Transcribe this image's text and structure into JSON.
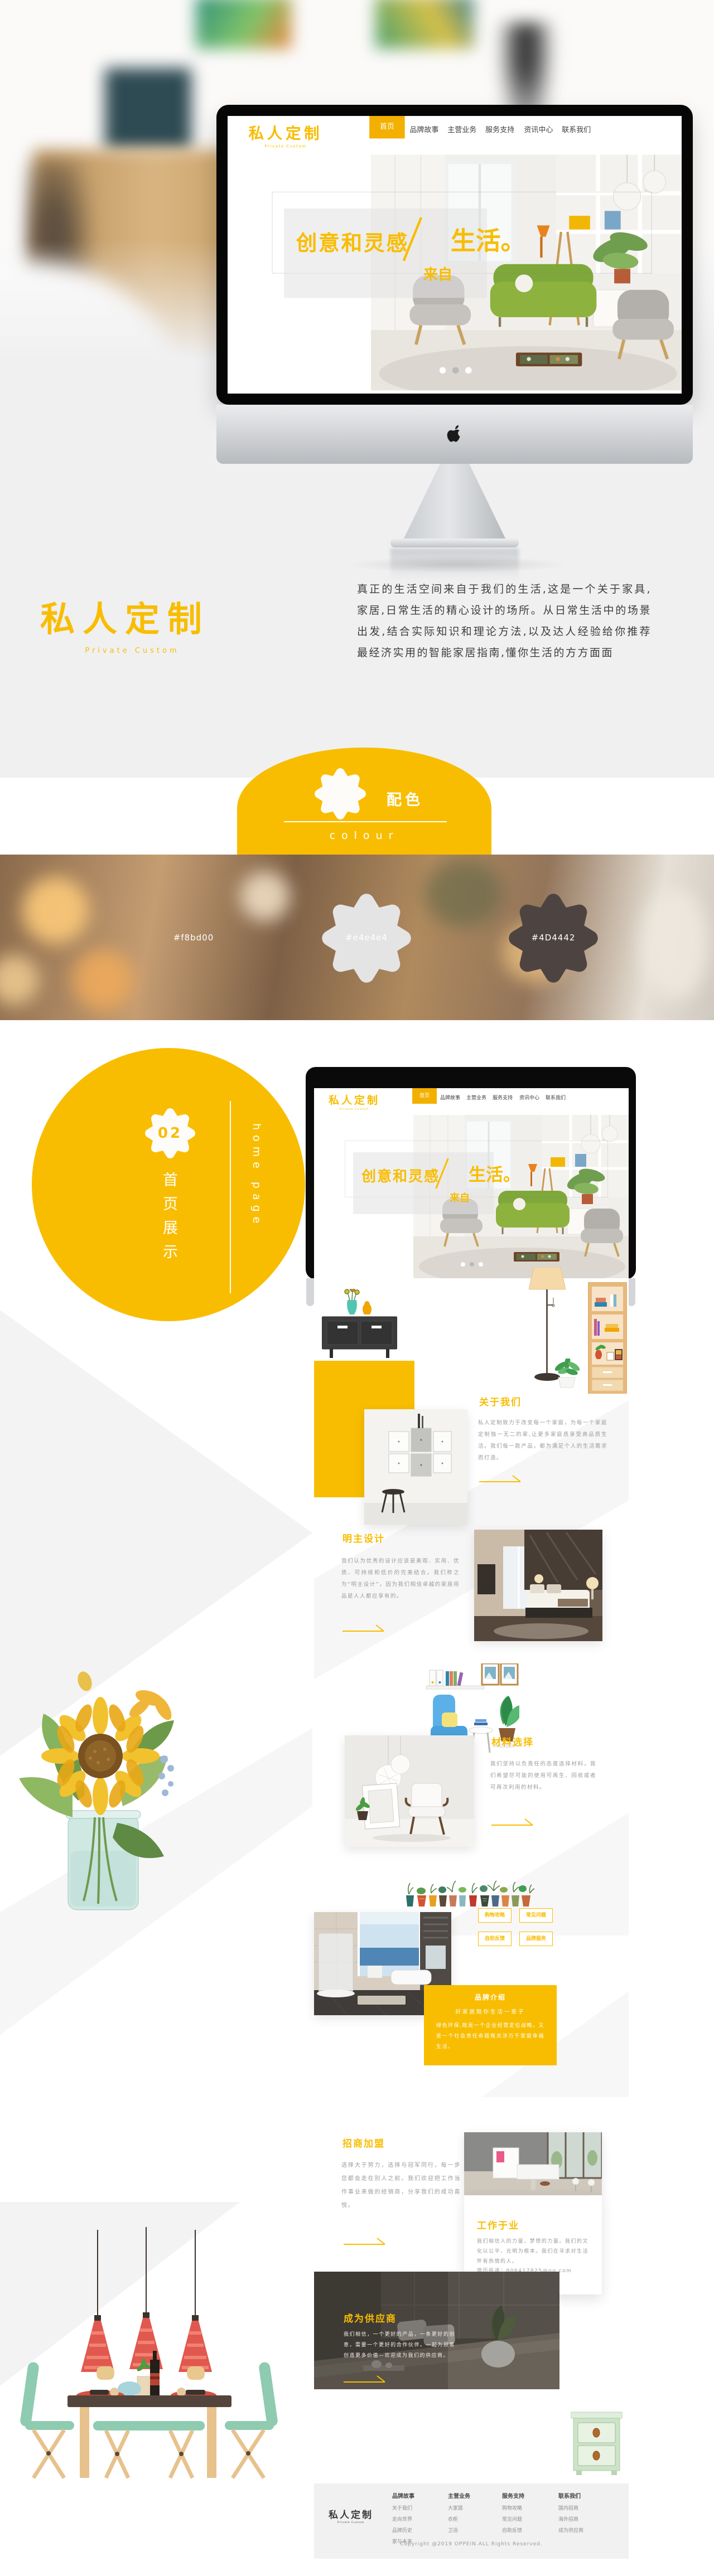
{
  "site": {
    "logo": "私人定制",
    "logo_sub": "Private Custom",
    "nav": [
      "首页",
      "品牌故事",
      "主营业务",
      "服务支持",
      "资讯中心",
      "联系我们"
    ],
    "hero": {
      "line1": "创意和灵感",
      "from_word": "来自",
      "line2": "生活。"
    }
  },
  "intro": {
    "text": "真正的生活空间来自于我们的生活,这是一个关于家具,家居,日常生活的精心设计的场所。从日常生活中的场景出发,结合实际知识和理论方法,以及达人经验给你推荐最经济实用的智能家居指南,懂你生活的方方面面"
  },
  "section01": {
    "num": "01",
    "title": "配色",
    "subtitle": "colour"
  },
  "palette": [
    {
      "hex": "#f8bd00"
    },
    {
      "hex": "#e4e4e4"
    },
    {
      "hex": "#4D4442"
    }
  ],
  "section02": {
    "num": "02",
    "title": "首页展示",
    "subtitle": "home page"
  },
  "page": {
    "about": {
      "title": "关于我们",
      "text": "私人定制致力于改变每一个家庭，为每一个家庭定制独一无二的家,让更多家庭质享受高品质生活。我们每一款产品，都为满足个人的生活需求而打造。"
    },
    "design": {
      "title": "明主设计",
      "text": "我们认为优秀的设计应该是美观、实用、优质、可持续和低价的完美结合。我们称之为“明主设计”，因为我们相信卓越的家居用品是人人都应享有的。"
    },
    "materials": {
      "title": "材料选择",
      "text": "我们坚持以负责任的态度选择材料，我们希望尽可能的使用可再生、回收或者可再次利用的材料。"
    },
    "services": [
      "购物攻略",
      "常见问题",
      "自助反馈",
      "品牌服务"
    ],
    "brand": {
      "title": "品牌介绍",
      "subtitle": "好家居陪你生活一辈子",
      "text": "绿色环保,既是一个企业经营定位战略，又是一个社会责任命题既关涉万千家庭幸福生活。"
    },
    "join": {
      "title": "招商加盟",
      "text": "选择大于努力，选择与冠军同行，每一步您都会走在别人之前。我们欢迎把工作当作事业来做的经销商，分享我们的成功喜悦。"
    },
    "work": {
      "title": "工作于业",
      "text": "我们相信人的力量，梦想的力量。我们的文化以公平、光明为根本。我们在寻求对生活怀有热情的人。",
      "email": "简历投递：806417825@qq.com"
    },
    "supplier": {
      "title": "成为供应商",
      "text": "我们相信，一个更好的产品，一条更好的创意，需要一个更好的合作伙伴。一起为顾客创造更多价值—欢迎成为我们的供应商。"
    },
    "footer": {
      "logo": "私人定制",
      "logo_sub": "Private Custom",
      "columns": [
        {
          "title": "品牌故事",
          "links": [
            "关于我们",
            "走向世界",
            "品牌历史",
            "家与未来"
          ]
        },
        {
          "title": "主营业务",
          "links": [
            "大家居",
            "衣柜",
            "卫浴"
          ]
        },
        {
          "title": "服务支持",
          "links": [
            "购物攻略",
            "常见问题",
            "自助反馈"
          ]
        },
        {
          "title": "联系我们",
          "links": [
            "国内招商",
            "海外招商",
            "成为供应商"
          ]
        }
      ],
      "copyright": "Copyright @2019 OPPEIN.ALL Rights Reserved."
    }
  }
}
